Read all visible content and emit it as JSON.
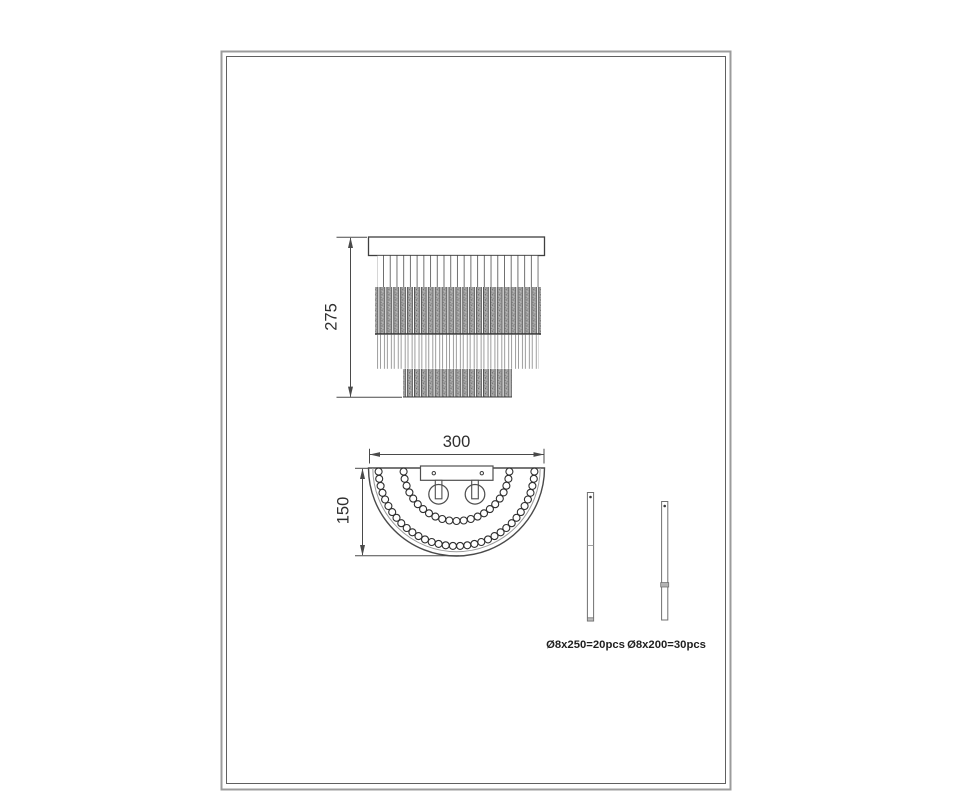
{
  "dimensions": {
    "front_height_mm": "275",
    "width_mm": "300",
    "depth_mm": "150"
  },
  "rod_specs": [
    {
      "label": "Ø8x250=20pcs"
    },
    {
      "label": "Ø8x200=30pcs"
    }
  ],
  "colors": {
    "line": "#3f3f3f",
    "dimension_line": "#4a4a4a",
    "text": "#2f2f2f",
    "frame_outer": "#9c9c9c",
    "frame_inner": "#606060",
    "background": "#ffffff"
  }
}
